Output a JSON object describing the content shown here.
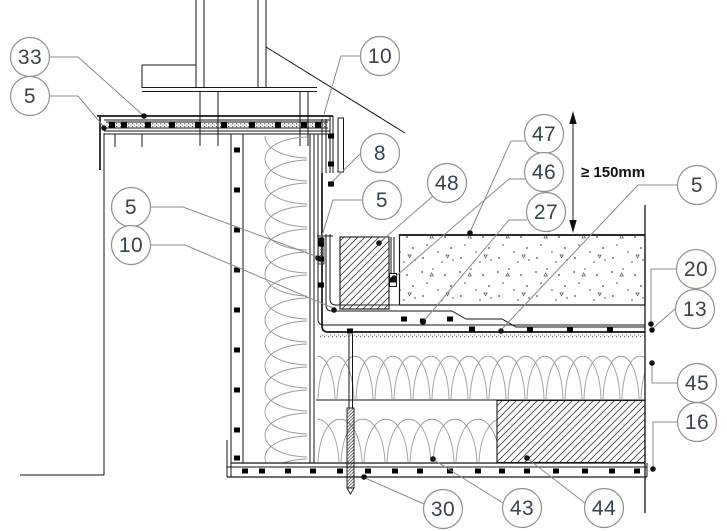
{
  "drawing": {
    "dimension": {
      "label": "≥ 150mm"
    },
    "colors": {
      "line": "#161616",
      "leader": "#8a8a8a",
      "callout_stroke": "#919191",
      "callout_number": "#39434e",
      "dimension_text": "#101010",
      "background": "#ffffff"
    },
    "callouts": [
      {
        "id": "33",
        "label": "33"
      },
      {
        "id": "5-top-left",
        "label": "5"
      },
      {
        "id": "10-top",
        "label": "10"
      },
      {
        "id": "8",
        "label": "8"
      },
      {
        "id": "5-left",
        "label": "5"
      },
      {
        "id": "10-left",
        "label": "10"
      },
      {
        "id": "5-mid",
        "label": "5"
      },
      {
        "id": "48",
        "label": "48"
      },
      {
        "id": "47",
        "label": "47"
      },
      {
        "id": "46",
        "label": "46"
      },
      {
        "id": "27",
        "label": "27"
      },
      {
        "id": "5-right",
        "label": "5"
      },
      {
        "id": "20",
        "label": "20"
      },
      {
        "id": "13",
        "label": "13"
      },
      {
        "id": "45",
        "label": "45"
      },
      {
        "id": "16",
        "label": "16"
      },
      {
        "id": "30",
        "label": "30"
      },
      {
        "id": "43",
        "label": "43"
      },
      {
        "id": "44",
        "label": "44"
      }
    ]
  }
}
